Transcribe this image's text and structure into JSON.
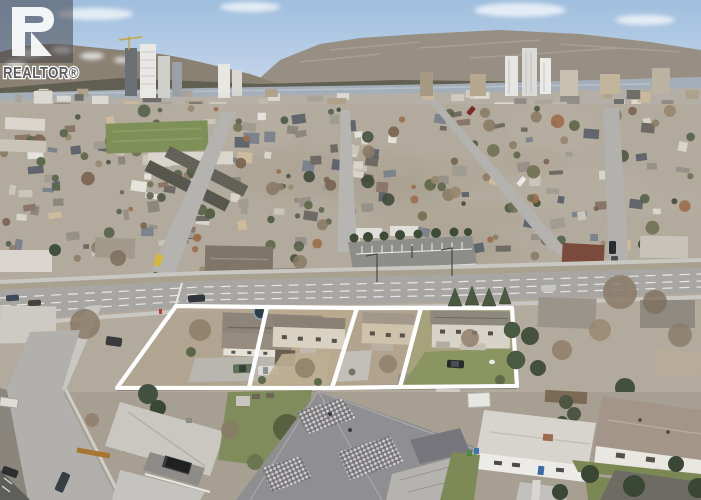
{
  "watermark": {
    "brand": "REALTOR®"
  },
  "overlay": {
    "stroke": "#ffffff",
    "stroke_width": 4.2,
    "lots": [
      {
        "points": "176,306 267,307 249,388 117,388"
      },
      {
        "points": "267,307 357,308 332,388 249,388"
      },
      {
        "points": "357,308 421,308 400,387 332,388"
      },
      {
        "points": "421,308 512,308 517,386 400,387"
      }
    ]
  },
  "palette": {
    "sky_top": "#9fbedd",
    "sky_horizon": "#dae6f2",
    "mountain": "#968e82",
    "lake": "#a4aeb9",
    "city": "#b4afa6",
    "neighborhood": "#b2aa9c",
    "field": "#7e9058",
    "road": "#a7a6a2",
    "marking": "#ffffff",
    "grass": "#87935f",
    "dry_yard": "#b5a78d",
    "watermark_box": "#404045",
    "watermark_text": "#5b5b60"
  }
}
